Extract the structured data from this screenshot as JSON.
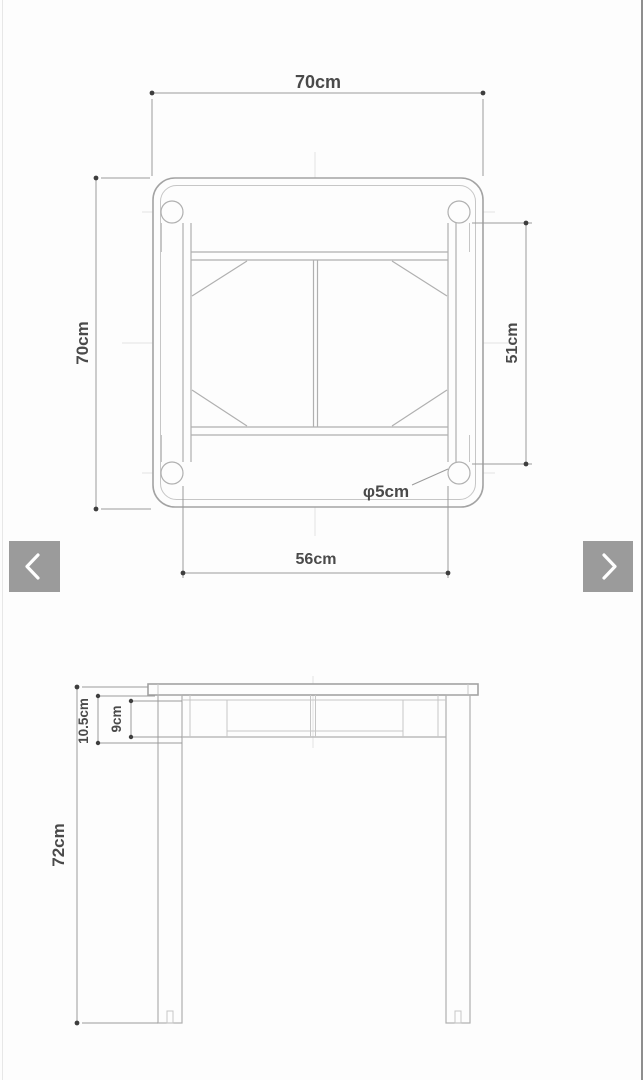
{
  "page": {
    "background": "#fdfdfd",
    "right_edge_color": "#8e8e8e",
    "left_edge_color": "#e7e7e7"
  },
  "carousel": {
    "prev_button": {
      "icon": "chevron-left",
      "color": "#9b9b9b",
      "glyph_color": "#ffffff"
    },
    "next_button": {
      "icon": "chevron-right",
      "color": "#9b9b9b",
      "glyph_color": "#ffffff"
    }
  },
  "drawing": {
    "line_color": "#b0b0b0",
    "dimension_line_color": "#9a9a9a",
    "label_color": "#4a4a4a",
    "top_view": {
      "description": "table top (plan) view with four round legs and apron frame",
      "labels": {
        "width": "70cm",
        "depth": "70cm",
        "leg_span_width": "56cm",
        "leg_span_depth": "51cm",
        "leg_diameter": "φ5cm"
      }
    },
    "side_view": {
      "description": "table side elevation view",
      "labels": {
        "height": "72cm",
        "top_to_apron": "10.5cm",
        "apron_height": "9cm"
      }
    }
  }
}
